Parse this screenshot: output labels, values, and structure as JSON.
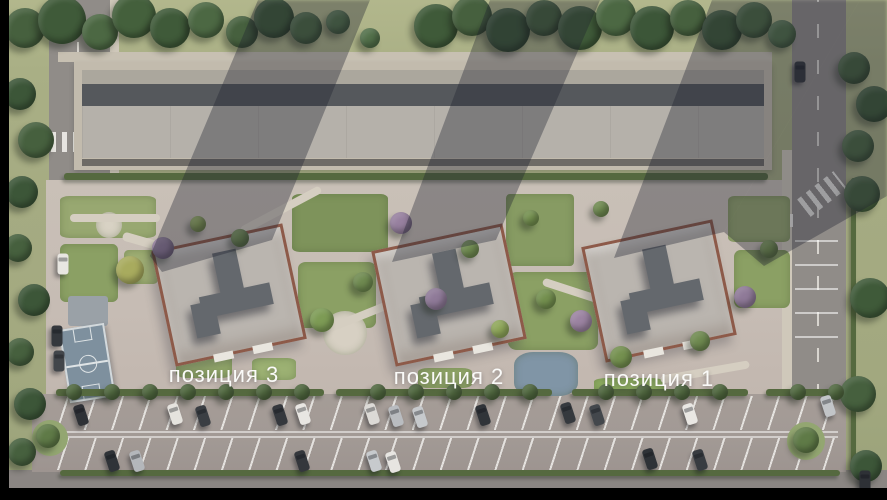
{
  "labels": [
    {
      "text": "позиция 3",
      "x": 224,
      "y": 375
    },
    {
      "text": "позиция 2",
      "x": 449,
      "y": 377
    },
    {
      "text": "позиция 1",
      "x": 659,
      "y": 379
    }
  ],
  "palette": {
    "grass": "#a8ae85",
    "road": "#908c88",
    "sidewalk": "#cfc8ba",
    "site_paving": "#c6bdb4",
    "parking_asphalt": "#a29a95",
    "garage_roof": "#b5b1aa",
    "garage_wall": "#55585c",
    "tower_roof": "#bab5af",
    "tower_parapet": "#8d5a49",
    "roof_core": "#64686d",
    "hedge": "#55693f",
    "tree_green": "#46603e",
    "tree_lime": "#a8ab5e",
    "tree_purple": "#8f7a98",
    "court_blue": "#7e909e",
    "pond_blue": "#8095a6",
    "car_white": "#e8e6e1",
    "car_dark": "#34373c",
    "shadow": "rgba(30,34,46,0.36)",
    "label_text": "#fafaf8",
    "letterbox": "#000000"
  },
  "scene": {
    "buildings": [
      {
        "x": 229,
        "y": 295
      },
      {
        "x": 449,
        "y": 295
      },
      {
        "x": 659,
        "y": 291
      }
    ],
    "shadows": [
      "150px 256px,258px 0px,370px 0px,272px 240px,162px 272px",
      "392px 262px,490px 0px,600px 0px,496px 240px",
      "614px 258px,712px 0px,860px 0px,724px 232px",
      "724px 232px,860px 0px,887px 0px,887px 196px,764px 266px"
    ],
    "gardens": [
      [
        60,
        196,
        96,
        42,
        "#98a871",
        10
      ],
      [
        60,
        244,
        58,
        58,
        "#8ba064",
        10
      ],
      [
        124,
        250,
        34,
        34,
        "#9fae74",
        14
      ],
      [
        292,
        194,
        96,
        58,
        "#7e935b",
        8
      ],
      [
        298,
        262,
        78,
        66,
        "#8ba064",
        10
      ],
      [
        506,
        194,
        68,
        72,
        "#879b63",
        6
      ],
      [
        508,
        272,
        90,
        78,
        "#8ba064",
        10
      ],
      [
        728,
        196,
        62,
        46,
        "#98a871",
        10
      ],
      [
        734,
        250,
        56,
        58,
        "#8ba064",
        12
      ],
      [
        594,
        378,
        70,
        18,
        "#8fae62",
        20
      ],
      [
        418,
        368,
        54,
        20,
        "#94a96b",
        20
      ],
      [
        176,
        352,
        56,
        26,
        "#94a96b",
        20
      ],
      [
        252,
        358,
        44,
        22,
        "#9cb173",
        20
      ],
      [
        323,
        311,
        44,
        44,
        "#d7d0c3",
        50
      ],
      [
        514,
        352,
        64,
        44,
        "#8095a6",
        30
      ],
      [
        96,
        212,
        26,
        26,
        "#d8d2c4",
        50
      ]
    ],
    "paths": [
      [
        120,
        252,
        150,
        9,
        16
      ],
      [
        236,
        206,
        90,
        8,
        -28
      ],
      [
        320,
        298,
        150,
        8,
        -22
      ],
      [
        540,
        296,
        120,
        8,
        18
      ],
      [
        660,
        368,
        90,
        8,
        -10
      ],
      [
        70,
        214,
        90,
        8,
        0
      ]
    ],
    "hedges": [
      [
        64,
        173,
        704,
        7
      ],
      [
        56,
        389,
        268,
        7
      ],
      [
        336,
        389,
        216,
        7
      ],
      [
        572,
        389,
        176,
        7
      ],
      [
        766,
        389,
        80,
        7
      ],
      [
        60,
        470,
        780,
        6
      ],
      [
        851,
        178,
        5,
        292
      ]
    ],
    "trees": [
      [
        25,
        28,
        20,
        "#46603e"
      ],
      [
        62,
        20,
        24,
        "#3f5a39"
      ],
      [
        100,
        32,
        18,
        "#4c6843"
      ],
      [
        134,
        16,
        22,
        "#44603c"
      ],
      [
        170,
        28,
        20,
        "#3f5a39"
      ],
      [
        206,
        20,
        18,
        "#4c6843"
      ],
      [
        242,
        32,
        16,
        "#46603e"
      ],
      [
        274,
        18,
        20,
        "#3f5a39"
      ],
      [
        306,
        28,
        16,
        "#4c6843"
      ],
      [
        338,
        22,
        12,
        "#52704a"
      ],
      [
        370,
        38,
        10,
        "#52704a"
      ],
      [
        436,
        26,
        22,
        "#3f5a39"
      ],
      [
        472,
        16,
        20,
        "#46603e"
      ],
      [
        508,
        30,
        22,
        "#3c5638"
      ],
      [
        544,
        18,
        18,
        "#46603e"
      ],
      [
        580,
        28,
        22,
        "#3f5a39"
      ],
      [
        616,
        16,
        20,
        "#4c6843"
      ],
      [
        652,
        28,
        22,
        "#3c5638"
      ],
      [
        688,
        18,
        18,
        "#46603e"
      ],
      [
        722,
        30,
        20,
        "#3f5a39"
      ],
      [
        754,
        20,
        18,
        "#4c6843"
      ],
      [
        782,
        34,
        14,
        "#52704a"
      ],
      [
        854,
        68,
        16,
        "#46603e"
      ],
      [
        874,
        104,
        18,
        "#3f5a39"
      ],
      [
        858,
        146,
        16,
        "#4c6843"
      ],
      [
        862,
        194,
        18,
        "#46603e"
      ],
      [
        870,
        298,
        20,
        "#3f5a39"
      ],
      [
        858,
        394,
        18,
        "#46603e"
      ],
      [
        866,
        466,
        16,
        "#3c5638"
      ],
      [
        20,
        94,
        16,
        "#3c5638"
      ],
      [
        36,
        140,
        18,
        "#46603e"
      ],
      [
        22,
        192,
        16,
        "#3c5638"
      ],
      [
        18,
        248,
        14,
        "#46603e"
      ],
      [
        34,
        300,
        16,
        "#3c5638"
      ],
      [
        20,
        352,
        14,
        "#46603e"
      ],
      [
        30,
        404,
        16,
        "#3c5638"
      ],
      [
        22,
        452,
        14,
        "#46603e"
      ],
      [
        130,
        270,
        14,
        "#a8ab5e"
      ],
      [
        163,
        248,
        11,
        "#8f7a98"
      ],
      [
        322,
        320,
        12,
        "#7d9b55"
      ],
      [
        363,
        282,
        10,
        "#6f8a50"
      ],
      [
        401,
        223,
        11,
        "#97809f"
      ],
      [
        436,
        299,
        11,
        "#8f7a98"
      ],
      [
        470,
        249,
        9,
        "#6f8a50"
      ],
      [
        500,
        329,
        9,
        "#8fa75a"
      ],
      [
        531,
        218,
        8,
        "#74904f"
      ],
      [
        546,
        299,
        10,
        "#74904f"
      ],
      [
        581,
        321,
        11,
        "#9b83a1"
      ],
      [
        601,
        209,
        8,
        "#6f8a50"
      ],
      [
        621,
        357,
        11,
        "#74904f"
      ],
      [
        700,
        341,
        10,
        "#6f8a50"
      ],
      [
        745,
        297,
        11,
        "#8f7a98"
      ],
      [
        769,
        249,
        9,
        "#74904f"
      ],
      [
        240,
        238,
        9,
        "#6f8a50"
      ],
      [
        198,
        224,
        8,
        "#8fa75a"
      ],
      [
        74,
        392,
        8,
        "#50683f"
      ],
      [
        112,
        392,
        8,
        "#50683f"
      ],
      [
        150,
        392,
        8,
        "#50683f"
      ],
      [
        188,
        392,
        8,
        "#50683f"
      ],
      [
        226,
        392,
        8,
        "#50683f"
      ],
      [
        264,
        392,
        8,
        "#50683f"
      ],
      [
        302,
        392,
        8,
        "#50683f"
      ],
      [
        378,
        392,
        8,
        "#50683f"
      ],
      [
        416,
        392,
        8,
        "#50683f"
      ],
      [
        454,
        392,
        8,
        "#50683f"
      ],
      [
        492,
        392,
        8,
        "#50683f"
      ],
      [
        530,
        392,
        8,
        "#50683f"
      ],
      [
        606,
        392,
        8,
        "#50683f"
      ],
      [
        644,
        392,
        8,
        "#50683f"
      ],
      [
        682,
        392,
        8,
        "#50683f"
      ],
      [
        720,
        392,
        8,
        "#50683f"
      ],
      [
        798,
        392,
        8,
        "#50683f"
      ],
      [
        836,
        392,
        8,
        "#50683f"
      ],
      [
        48,
        436,
        12,
        "#5f7a47"
      ],
      [
        806,
        440,
        13,
        "#5f7a47"
      ]
    ],
    "cars": [
      [
        800,
        72,
        0,
        "#34373c"
      ],
      [
        63,
        264,
        0,
        "#e8e6e1"
      ],
      [
        57,
        336,
        0,
        "#34383d"
      ],
      [
        59,
        361,
        0,
        "#42464b"
      ],
      [
        865,
        481,
        0,
        "#2e3136"
      ],
      [
        81,
        415,
        -18,
        "#2e3136"
      ],
      [
        175,
        414,
        -18,
        "#e5e3de"
      ],
      [
        203,
        416,
        -18,
        "#3a3e43"
      ],
      [
        280,
        415,
        -18,
        "#35383d"
      ],
      [
        303,
        414,
        -18,
        "#e8e6e2"
      ],
      [
        372,
        414,
        -18,
        "#dcdad6"
      ],
      [
        396,
        416,
        -18,
        "#b9bcc0"
      ],
      [
        420,
        417,
        -18,
        "#c6c9cc"
      ],
      [
        483,
        415,
        -18,
        "#303439"
      ],
      [
        568,
        413,
        -18,
        "#35393e"
      ],
      [
        597,
        415,
        -18,
        "#43474c"
      ],
      [
        690,
        414,
        -18,
        "#e9e7e3"
      ],
      [
        828,
        406,
        -18,
        "#c2c5c8"
      ],
      [
        112,
        461,
        -18,
        "#2f3338"
      ],
      [
        137,
        461,
        -18,
        "#b4b7bb"
      ],
      [
        302,
        461,
        -18,
        "#34373c"
      ],
      [
        374,
        461,
        -18,
        "#c7cacd"
      ],
      [
        393,
        462,
        -18,
        "#e7e5e1"
      ],
      [
        650,
        459,
        -18,
        "#2e3237"
      ],
      [
        700,
        460,
        -18,
        "#383c41"
      ]
    ]
  }
}
